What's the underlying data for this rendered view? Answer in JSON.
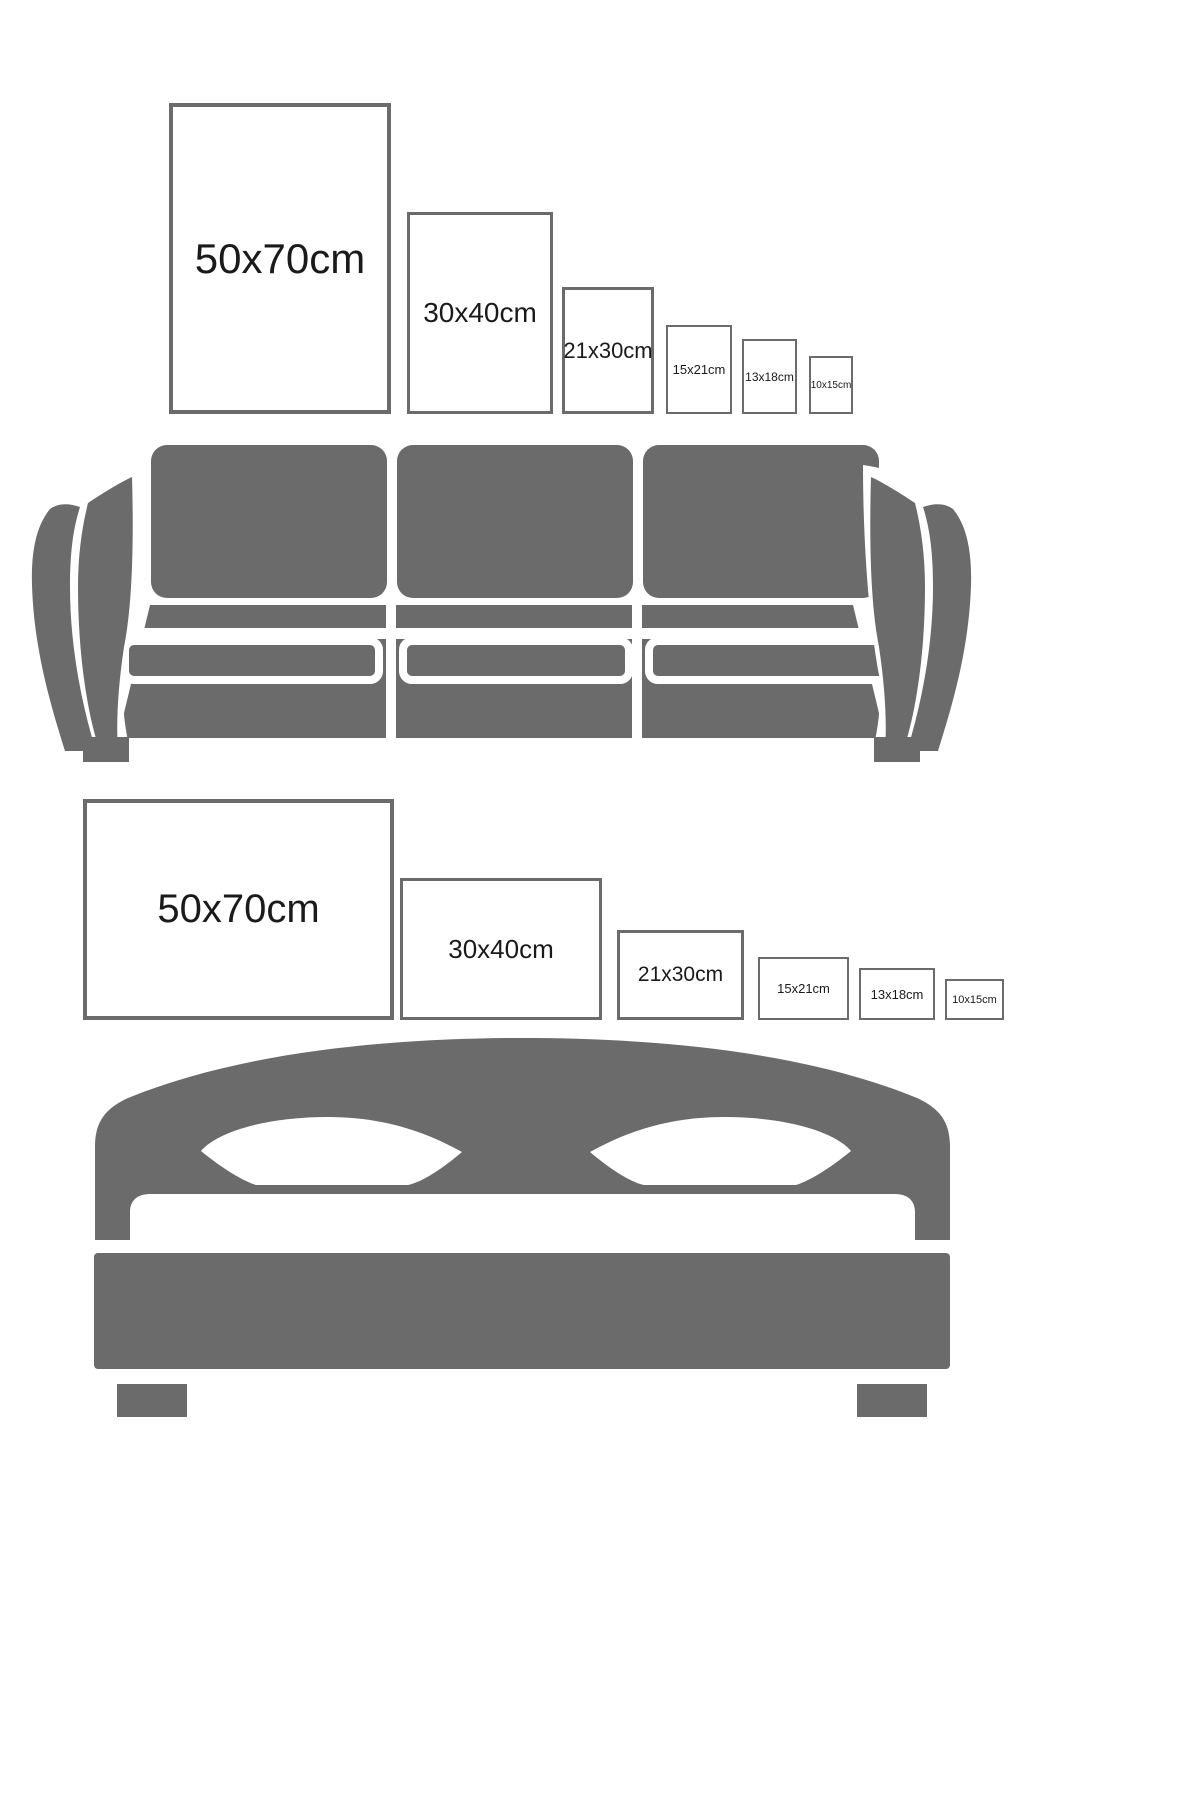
{
  "colors": {
    "background": "#ffffff",
    "furniture_gray": "#6b6b6b",
    "frame_border_gray": "#6b6b6b",
    "label_text": "#1a1a1a"
  },
  "sofa_section": {
    "furniture": "sofa-illustration",
    "frames": [
      {
        "label": "50x70cm",
        "orientation": "portrait"
      },
      {
        "label": "30x40cm",
        "orientation": "portrait"
      },
      {
        "label": "21x30cm",
        "orientation": "portrait"
      },
      {
        "label": "15x21cm",
        "orientation": "portrait"
      },
      {
        "label": "13x18cm",
        "orientation": "portrait"
      },
      {
        "label": "10x15cm",
        "orientation": "portrait"
      }
    ]
  },
  "bed_section": {
    "furniture": "bed-illustration",
    "frames": [
      {
        "label": "50x70cm",
        "orientation": "landscape"
      },
      {
        "label": "30x40cm",
        "orientation": "landscape"
      },
      {
        "label": "21x30cm",
        "orientation": "landscape"
      },
      {
        "label": "15x21cm",
        "orientation": "landscape"
      },
      {
        "label": "13x18cm",
        "orientation": "landscape"
      },
      {
        "label": "10x15cm",
        "orientation": "landscape"
      }
    ]
  }
}
